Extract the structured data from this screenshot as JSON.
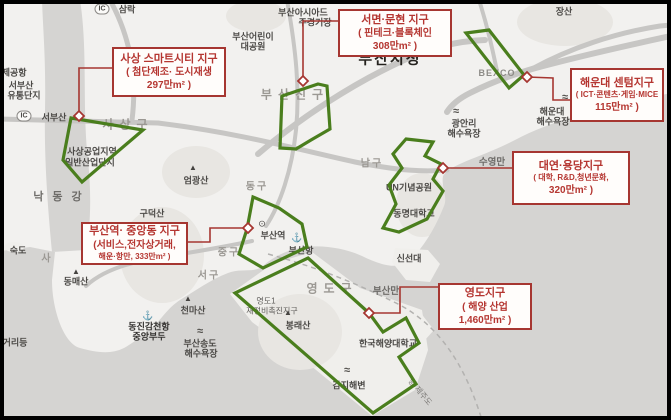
{
  "figure": {
    "type": "annotated-map",
    "city": "부산"
  },
  "map": {
    "ic_text": "IC",
    "icon_glyphs": {
      "mountain": "▲",
      "beach": "≈",
      "station": "⊙",
      "anchor": "⚓"
    },
    "colors": {
      "zone_green": "#4a7e1d",
      "callout_red": "#a63631",
      "sea": "#d5d4d2",
      "land": "#f2f1ef"
    },
    "labels": [
      {
        "t": "삼락",
        "x": 127,
        "y": 9,
        "c": "place"
      },
      {
        "t": "부산아시아드",
        "x": 303,
        "y": 12,
        "c": "place"
      },
      {
        "t": "주경기장",
        "x": 315,
        "y": 22,
        "c": "place"
      },
      {
        "t": "장산",
        "x": 564,
        "y": 11,
        "c": "place"
      },
      {
        "t": "부산어린이",
        "x": 253,
        "y": 36,
        "c": "place"
      },
      {
        "t": "대공원",
        "x": 253,
        "y": 46,
        "c": "place"
      },
      {
        "t": "부산시청",
        "x": 390,
        "y": 58,
        "c": "cityhall"
      },
      {
        "t": "부산진구",
        "x": 295,
        "y": 94,
        "c": "district"
      },
      {
        "t": "국제공항",
        "x": 10,
        "y": 72,
        "c": "place"
      },
      {
        "t": "서부산",
        "x": 21,
        "y": 85,
        "c": "place"
      },
      {
        "t": "유통단지",
        "x": 24,
        "y": 95,
        "c": "place"
      },
      {
        "t": "서부산",
        "x": 54,
        "y": 117,
        "c": "place"
      },
      {
        "t": "사상구",
        "x": 128,
        "y": 124,
        "c": "district"
      },
      {
        "t": "사상공업지역",
        "x": 92,
        "y": 151,
        "c": "place"
      },
      {
        "t": "일반산업단지",
        "x": 90,
        "y": 162,
        "c": "place"
      },
      {
        "t": "낙동강",
        "x": 62,
        "y": 196,
        "c": "water-wide"
      },
      {
        "t": "엄광산",
        "x": 196,
        "y": 180,
        "c": "place"
      },
      {
        "t": "동구",
        "x": 257,
        "y": 185,
        "c": "district-sm"
      },
      {
        "t": "BEXCO",
        "x": 497,
        "y": 73,
        "c": "caps"
      },
      {
        "t": "광안리",
        "x": 464,
        "y": 123,
        "c": "place"
      },
      {
        "t": "해수욕장",
        "x": 464,
        "y": 133,
        "c": "place"
      },
      {
        "t": "해운대",
        "x": 552,
        "y": 111,
        "c": "place"
      },
      {
        "t": "해수욕장",
        "x": 553,
        "y": 121,
        "c": "place"
      },
      {
        "t": "남구",
        "x": 372,
        "y": 162,
        "c": "district-sm"
      },
      {
        "t": "수영만",
        "x": 492,
        "y": 161,
        "c": "water"
      },
      {
        "t": "UN기념공원",
        "x": 409,
        "y": 187,
        "c": "place"
      },
      {
        "t": "동명대학교",
        "x": 414,
        "y": 213,
        "c": "place"
      },
      {
        "t": "신선대",
        "x": 409,
        "y": 258,
        "c": "place"
      },
      {
        "t": "구덕산",
        "x": 152,
        "y": 213,
        "c": "place"
      },
      {
        "t": "숙도",
        "x": 18,
        "y": 250,
        "c": "place"
      },
      {
        "t": "사",
        "x": 47,
        "y": 257,
        "c": "district-sm"
      },
      {
        "t": "동매산",
        "x": 76,
        "y": 281,
        "c": "place"
      },
      {
        "t": "천마산",
        "x": 193,
        "y": 310,
        "c": "place"
      },
      {
        "t": "중구",
        "x": 229,
        "y": 251,
        "c": "district-sm"
      },
      {
        "t": "서구",
        "x": 209,
        "y": 274,
        "c": "district-sm"
      },
      {
        "t": "부산역",
        "x": 273,
        "y": 235,
        "c": "place"
      },
      {
        "t": "부산항",
        "x": 301,
        "y": 250,
        "c": "place"
      },
      {
        "t": "영도구",
        "x": 332,
        "y": 288,
        "c": "district"
      },
      {
        "t": "부산만",
        "x": 386,
        "y": 290,
        "c": "water"
      },
      {
        "t": "영도1",
        "x": 266,
        "y": 301,
        "c": "small"
      },
      {
        "t": "재정비촉진지구",
        "x": 272,
        "y": 311,
        "c": "small"
      },
      {
        "t": "봉래산",
        "x": 298,
        "y": 325,
        "c": "place"
      },
      {
        "t": "한국해양대학교",
        "x": 388,
        "y": 343,
        "c": "place"
      },
      {
        "t": "동진감천항",
        "x": 149,
        "y": 326,
        "c": "place-dk"
      },
      {
        "t": "중앙부두",
        "x": 149,
        "y": 336,
        "c": "place-dk"
      },
      {
        "t": "부산송도",
        "x": 200,
        "y": 343,
        "c": "place"
      },
      {
        "t": "해수욕장",
        "x": 201,
        "y": 353,
        "c": "place"
      },
      {
        "t": "감지해변",
        "x": 349,
        "y": 385,
        "c": "place"
      },
      {
        "t": "거리등",
        "x": 15,
        "y": 342,
        "c": "place"
      },
      {
        "t": "항·제주도",
        "x": 420,
        "y": 392,
        "c": "rot",
        "rot": 50
      }
    ],
    "icons": [
      {
        "type": "mountain",
        "x": 193,
        "y": 168
      },
      {
        "type": "mountain",
        "x": 76,
        "y": 272
      },
      {
        "type": "mountain",
        "x": 188,
        "y": 299
      },
      {
        "type": "mountain",
        "x": 288,
        "y": 313
      },
      {
        "type": "beach",
        "x": 456,
        "y": 112
      },
      {
        "type": "beach",
        "x": 565,
        "y": 98
      },
      {
        "type": "beach",
        "x": 200,
        "y": 332
      },
      {
        "type": "beach",
        "x": 347,
        "y": 371
      },
      {
        "type": "station",
        "x": 262,
        "y": 224
      },
      {
        "type": "anchor",
        "x": 297,
        "y": 238
      },
      {
        "type": "anchor",
        "x": 148,
        "y": 316
      }
    ],
    "ic_badges": [
      {
        "x": 102,
        "y": 9
      },
      {
        "x": 24,
        "y": 116
      }
    ],
    "zones": [
      {
        "id": "sasang",
        "points": "71,118 143,130 82,182 63,160"
      },
      {
        "id": "busanjin",
        "points": "318,84 282,96 280,148 296,149 311,140 330,129 327,86"
      },
      {
        "id": "centum",
        "points": "466,33 489,30 524,75 509,88"
      },
      {
        "id": "daeyeon",
        "points": "406,139 433,142 425,156 441,164 433,179 443,191 427,219 399,232 383,228 396,204 389,185 402,168 393,154"
      },
      {
        "id": "jungang",
        "points": "253,197 279,208 302,224 307,247 263,268 239,254 247,229"
      },
      {
        "id": "yeongdo",
        "points": "308,258 369,313 383,332 406,318 419,343 399,357 416,384 373,413 235,293"
      }
    ],
    "callouts": [
      {
        "id": "sasang",
        "lines": [
          "사상 스마트시티 지구",
          "( 첨단제조· 도시재생",
          "297만m² )"
        ],
        "box": {
          "x": 112,
          "y": 47,
          "w": 114,
          "h": 50
        },
        "marker": {
          "x": 79,
          "y": 116
        },
        "leader": "M79,116 L79,68 L112,68"
      },
      {
        "id": "seomyeon",
        "lines": [
          "서면·문현 지구",
          "( 핀테크·블록체인",
          "308만m² )"
        ],
        "box": {
          "x": 338,
          "y": 9,
          "w": 114,
          "h": 48
        },
        "marker": {
          "x": 303,
          "y": 81
        },
        "leader": "M303,81 L303,21 L338,21"
      },
      {
        "id": "haeundae",
        "lines": [
          "해운대 센텀지구",
          "( ICT·콘텐츠·게임·MICE",
          "115만m² )"
        ],
        "box": {
          "x": 570,
          "y": 68,
          "w": 94,
          "h": 54
        },
        "marker": {
          "x": 527,
          "y": 77
        },
        "leader": "M527,77 L553,78 L553,100 L570,100"
      },
      {
        "id": "daeyeon",
        "lines": [
          "대연·용당지구",
          "( 대학, R&D,청년문화,",
          "320만m² )"
        ],
        "box": {
          "x": 512,
          "y": 151,
          "w": 118,
          "h": 54
        },
        "marker": {
          "x": 443,
          "y": 168
        },
        "leader": "M443,168 L512,168"
      },
      {
        "id": "jungang",
        "lines": [
          "부산역· 중앙동 지구",
          "(서비스,전자상거래,",
          "해운·항만, 333만m² )"
        ],
        "box": {
          "x": 81,
          "y": 222,
          "w": 107,
          "h": 43
        },
        "marker": {
          "x": 248,
          "y": 228
        },
        "leader": "M188,242 L210,242 L210,228 L244,228"
      },
      {
        "id": "yeongdo",
        "lines": [
          "영도지구",
          "( 해양 산업",
          "1,460만m² )"
        ],
        "box": {
          "x": 438,
          "y": 283,
          "w": 94,
          "h": 47
        },
        "marker": {
          "x": 369,
          "y": 313
        },
        "leader": "M369,313 L400,313 L400,287 L438,287"
      }
    ]
  }
}
